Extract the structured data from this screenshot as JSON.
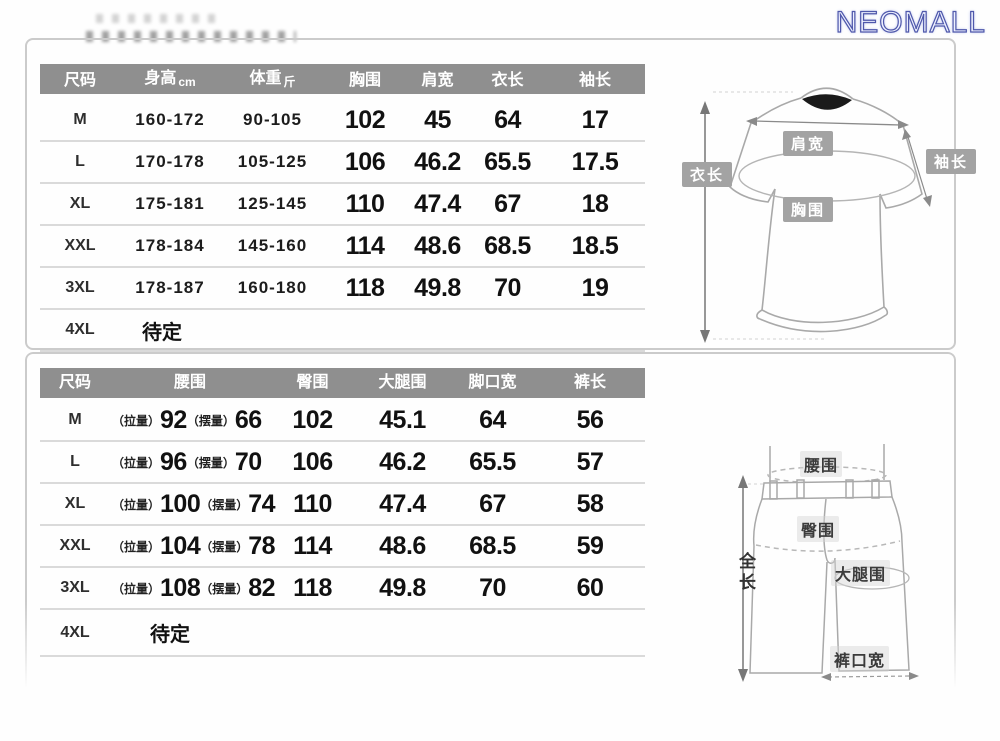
{
  "brand": {
    "logo_text": "NEOMALL"
  },
  "colors": {
    "header_bg": "#8f8f8f",
    "logo_blue": "#4f58ab",
    "border_gray": "#cbcbcb",
    "tag_bg": "#a3a3a3"
  },
  "top_table": {
    "headers": {
      "size": "尺码",
      "height": "身高",
      "height_unit": "cm",
      "weight": "体重",
      "weight_unit": "斤",
      "chest": "胸围",
      "shoulder": "肩宽",
      "length": "衣长",
      "sleeve": "袖长"
    },
    "rows": [
      {
        "size": "M",
        "height": "160-172",
        "weight": "90-105",
        "chest": "102",
        "shoulder": "45",
        "length": "64",
        "sleeve": "17"
      },
      {
        "size": "L",
        "height": "170-178",
        "weight": "105-125",
        "chest": "106",
        "shoulder": "46.2",
        "length": "65.5",
        "sleeve": "17.5"
      },
      {
        "size": "XL",
        "height": "175-181",
        "weight": "125-145",
        "chest": "110",
        "shoulder": "47.4",
        "length": "67",
        "sleeve": "18"
      },
      {
        "size": "XXL",
        "height": "178-184",
        "weight": "145-160",
        "chest": "114",
        "shoulder": "48.6",
        "length": "68.5",
        "sleeve": "18.5"
      },
      {
        "size": "3XL",
        "height": "178-187",
        "weight": "160-180",
        "chest": "118",
        "shoulder": "49.8",
        "length": "70",
        "sleeve": "19"
      }
    ],
    "pending_row": {
      "size": "4XL",
      "note": "待定"
    }
  },
  "bottom_table": {
    "headers": {
      "size": "尺码",
      "waist": "腰围",
      "hip": "臀围",
      "thigh": "大腿围",
      "leg_opening": "脚口宽",
      "length": "裤长"
    },
    "pull_label": "（拉量）",
    "swing_label": "（摆量）",
    "rows": [
      {
        "size": "M",
        "waist_pull": "92",
        "waist_swing": "66",
        "hip": "102",
        "thigh": "45.1",
        "leg_opening": "64",
        "length": "56"
      },
      {
        "size": "L",
        "waist_pull": "96",
        "waist_swing": "70",
        "hip": "106",
        "thigh": "46.2",
        "leg_opening": "65.5",
        "length": "57"
      },
      {
        "size": "XL",
        "waist_pull": "100",
        "waist_swing": "74",
        "hip": "110",
        "thigh": "47.4",
        "leg_opening": "67",
        "length": "58"
      },
      {
        "size": "XXL",
        "waist_pull": "104",
        "waist_swing": "78",
        "hip": "114",
        "thigh": "48.6",
        "leg_opening": "68.5",
        "length": "59"
      },
      {
        "size": "3XL",
        "waist_pull": "108",
        "waist_swing": "82",
        "hip": "118",
        "thigh": "49.8",
        "leg_opening": "70",
        "length": "60"
      }
    ],
    "pending_row": {
      "size": "4XL",
      "note": "待定"
    }
  },
  "shirt_diagram": {
    "shoulder_label": "肩宽",
    "sleeve_label": "袖长",
    "length_label": "衣长",
    "chest_label": "胸围"
  },
  "pants_diagram": {
    "waist_label": "腰围",
    "hip_label": "臀围",
    "thigh_label": "大腿围",
    "full_length_label": "全长",
    "leg_opening_label": "裤口宽"
  }
}
